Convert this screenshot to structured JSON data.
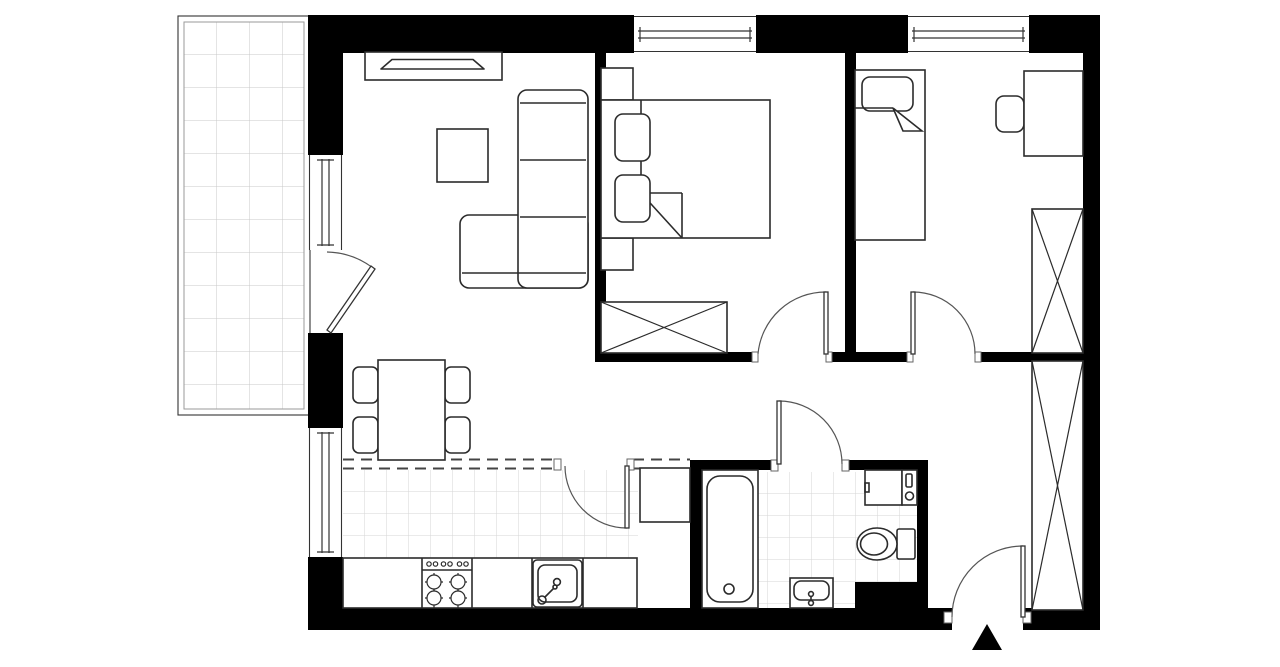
{
  "document": {
    "title": "Two-bedroom apartment floor plan",
    "type": "architectural-floor-plan-2d",
    "visible_text": "none"
  },
  "canvas": {
    "width": 1280,
    "height": 667
  },
  "colors": {
    "background": "#ffffff",
    "wall": "#000000",
    "furniture_line": "#2b2b2b",
    "door_arc": "#555555",
    "kitchen_tile_line": "#d6d6d6",
    "bathroom_tile_line": "#d6d6d6",
    "balcony_grid_line": "#c9c9c9",
    "entrance_arrow": "#000000"
  },
  "rooms": [
    {
      "id": "balcony",
      "label": "balcony",
      "features": [
        "tiled grid floor",
        "double-line railing border",
        "accessed by door from living room"
      ]
    },
    {
      "id": "living-room",
      "label": "living room with dining area",
      "features": [
        "tv console with tv",
        "square coffee table",
        "l-shaped corner sofa",
        "dining table",
        "four dining chairs",
        "balcony door",
        "two windows in left wall"
      ]
    },
    {
      "id": "kitchen",
      "label": "kitchen",
      "features": [
        "tiled floor",
        "straight counter",
        "four-burner stove with control knobs",
        "sink with faucet",
        "tall cabinet",
        "dashed glazed partition",
        "door from dining area"
      ]
    },
    {
      "id": "bedroom-1",
      "label": "bedroom 1 (double)",
      "features": [
        "double bed with folded blanket corner",
        "two pillows",
        "two nightstands",
        "crossed wardrobe",
        "window in top wall",
        "door to hallway"
      ]
    },
    {
      "id": "bedroom-2",
      "label": "bedroom 2 (single)",
      "features": [
        "single bed with pillow and folded blanket",
        "desk",
        "desk chair",
        "crossed wardrobe",
        "window in top wall",
        "door to hallway"
      ]
    },
    {
      "id": "bathroom",
      "label": "bathroom",
      "features": [
        "tiled floor",
        "bathtub with drain",
        "washing machine",
        "utility unit",
        "toilet with tank",
        "washbasin",
        "black service shaft block",
        "door opening to hallway"
      ]
    },
    {
      "id": "hallway",
      "label": "hallway / entrance corridor",
      "features": [
        "tall crossed built-in wardrobe",
        "entrance door",
        "entrance direction arrow"
      ]
    }
  ],
  "doors": [
    {
      "id": "balcony-door",
      "between": [
        "living-room",
        "balcony"
      ],
      "swing": "into living room"
    },
    {
      "id": "bedroom1-door",
      "between": [
        "hallway",
        "bedroom-1"
      ],
      "swing": "into bedroom 1"
    },
    {
      "id": "bedroom2-door",
      "between": [
        "hallway",
        "bedroom-2"
      ],
      "swing": "into bedroom 2"
    },
    {
      "id": "bathroom-door",
      "between": [
        "hallway",
        "bathroom"
      ],
      "swing": "out into hallway"
    },
    {
      "id": "kitchen-door",
      "between": [
        "dining area",
        "kitchen"
      ],
      "swing": "into kitchen"
    },
    {
      "id": "entrance-door",
      "between": [
        "outside",
        "hallway"
      ],
      "swing": "into hallway"
    }
  ],
  "windows": [
    {
      "id": "window-bedroom-1",
      "wall": "top"
    },
    {
      "id": "window-bedroom-2",
      "wall": "top"
    },
    {
      "id": "window-living-upper",
      "wall": "left"
    },
    {
      "id": "window-living-lower",
      "wall": "left"
    }
  ],
  "entrance_marker": {
    "shape": "filled-triangle",
    "direction": "up",
    "position": "below bottom wall at entrance door"
  }
}
